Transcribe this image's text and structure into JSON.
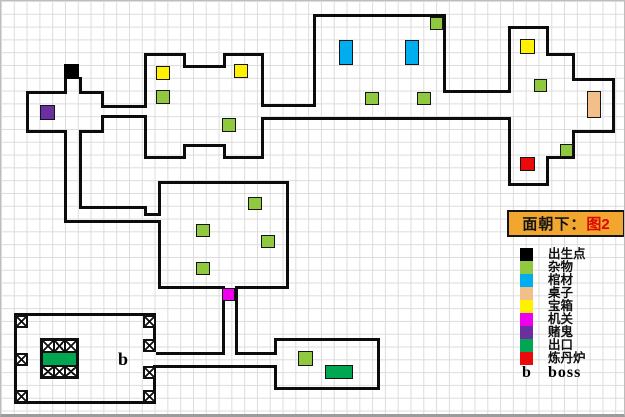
{
  "note": {
    "prefix": "面朝下：",
    "figure": "图2",
    "bg_color": "#F0A62F",
    "figure_color": "#DD0600"
  },
  "legend": {
    "items": [
      {
        "name": "spawn",
        "label": "出生点",
        "color": "#000000"
      },
      {
        "name": "junk",
        "label": "杂物",
        "color": "#90C93F"
      },
      {
        "name": "coffin",
        "label": "棺材",
        "color": "#00AEEF"
      },
      {
        "name": "table",
        "label": "桌子",
        "color": "#F2BE8A"
      },
      {
        "name": "chest",
        "label": "宝箱",
        "color": "#FFF100"
      },
      {
        "name": "mechanism",
        "label": "机关",
        "color": "#EE00EE"
      },
      {
        "name": "gambler",
        "label": "赌鬼",
        "color": "#6B2FA0"
      },
      {
        "name": "exit",
        "label": "出口",
        "color": "#00A651"
      },
      {
        "name": "furnace",
        "label": "炼丹炉",
        "color": "#EA0A0A"
      }
    ],
    "boss": {
      "symbol": "b",
      "label": "boss"
    }
  },
  "map": {
    "wall_color": "#0c0c0c",
    "grid_color": "#dcdcdc",
    "walls": [
      [
        25,
        90,
        41,
        3
      ],
      [
        78,
        90,
        25,
        3
      ],
      [
        25,
        90,
        3,
        42
      ],
      [
        25,
        129,
        41,
        3
      ],
      [
        78,
        129,
        25,
        3
      ],
      [
        100,
        90,
        3,
        17
      ],
      [
        100,
        114,
        3,
        18
      ],
      [
        63,
        76,
        3,
        16
      ],
      [
        78,
        76,
        3,
        16
      ],
      [
        100,
        104,
        46,
        3
      ],
      [
        100,
        114,
        46,
        3
      ],
      [
        143,
        52,
        42,
        3
      ],
      [
        182,
        52,
        3,
        15
      ],
      [
        182,
        64,
        43,
        3
      ],
      [
        222,
        52,
        3,
        15
      ],
      [
        222,
        52,
        41,
        3
      ],
      [
        143,
        52,
        3,
        52
      ],
      [
        143,
        117,
        3,
        41
      ],
      [
        143,
        155,
        42,
        3
      ],
      [
        182,
        143,
        3,
        15
      ],
      [
        182,
        143,
        43,
        3
      ],
      [
        222,
        143,
        3,
        15
      ],
      [
        222,
        155,
        41,
        3
      ],
      [
        260,
        52,
        3,
        51
      ],
      [
        260,
        116,
        3,
        42
      ],
      [
        260,
        103,
        55,
        3
      ],
      [
        260,
        116,
        250,
        3
      ],
      [
        312,
        13,
        133,
        3
      ],
      [
        312,
        13,
        3,
        90
      ],
      [
        442,
        13,
        3,
        76
      ],
      [
        442,
        89,
        68,
        3
      ],
      [
        507,
        25,
        41,
        3
      ],
      [
        507,
        25,
        3,
        64
      ],
      [
        507,
        117,
        3,
        68
      ],
      [
        507,
        182,
        41,
        3
      ],
      [
        545,
        155,
        3,
        30
      ],
      [
        545,
        155,
        29,
        3
      ],
      [
        571,
        129,
        3,
        29
      ],
      [
        571,
        129,
        43,
        3
      ],
      [
        611,
        77,
        3,
        55
      ],
      [
        571,
        77,
        43,
        3
      ],
      [
        571,
        52,
        3,
        28
      ],
      [
        545,
        52,
        29,
        3
      ],
      [
        545,
        25,
        3,
        30
      ],
      [
        157,
        180,
        131,
        3
      ],
      [
        157,
        180,
        3,
        32
      ],
      [
        157,
        219,
        3,
        69
      ],
      [
        285,
        180,
        3,
        108
      ],
      [
        157,
        285,
        67,
        3
      ],
      [
        234,
        285,
        54,
        3
      ],
      [
        63,
        129,
        3,
        93
      ],
      [
        78,
        129,
        3,
        79
      ],
      [
        78,
        205,
        68,
        3
      ],
      [
        143,
        205,
        3,
        10
      ],
      [
        143,
        212,
        17,
        3
      ],
      [
        63,
        219,
        97,
        3
      ],
      [
        221,
        285,
        3,
        69
      ],
      [
        234,
        285,
        3,
        69
      ],
      [
        155,
        351,
        66,
        3
      ],
      [
        234,
        351,
        42,
        3
      ],
      [
        155,
        364,
        121,
        3
      ],
      [
        13,
        312,
        142,
        3
      ],
      [
        13,
        312,
        3,
        91
      ],
      [
        13,
        400,
        142,
        3
      ],
      [
        152,
        312,
        3,
        39
      ],
      [
        152,
        364,
        3,
        39
      ],
      [
        273,
        337,
        106,
        3
      ],
      [
        273,
        337,
        3,
        14
      ],
      [
        273,
        364,
        3,
        25
      ],
      [
        273,
        386,
        106,
        3
      ],
      [
        376,
        337,
        3,
        52
      ]
    ],
    "items": [
      {
        "type": "spawn",
        "x": 63,
        "y": 63,
        "w": 15,
        "h": 15
      },
      {
        "type": "gambler",
        "x": 39,
        "y": 104,
        "w": 15,
        "h": 15
      },
      {
        "type": "chest",
        "x": 155,
        "y": 65,
        "w": 14,
        "h": 14
      },
      {
        "type": "junk",
        "x": 155,
        "y": 89,
        "w": 14,
        "h": 14
      },
      {
        "type": "chest",
        "x": 233,
        "y": 63,
        "w": 14,
        "h": 14
      },
      {
        "type": "junk",
        "x": 221,
        "y": 117,
        "w": 14,
        "h": 14
      },
      {
        "type": "coffin",
        "x": 338,
        "y": 39,
        "w": 14,
        "h": 25
      },
      {
        "type": "coffin",
        "x": 404,
        "y": 39,
        "w": 14,
        "h": 25
      },
      {
        "type": "junk",
        "x": 364,
        "y": 91,
        "w": 14,
        "h": 13
      },
      {
        "type": "junk",
        "x": 416,
        "y": 91,
        "w": 14,
        "h": 13
      },
      {
        "type": "junk",
        "x": 429,
        "y": 16,
        "w": 13,
        "h": 13
      },
      {
        "type": "chest",
        "x": 519,
        "y": 38,
        "w": 15,
        "h": 15
      },
      {
        "type": "junk",
        "x": 533,
        "y": 78,
        "w": 13,
        "h": 13
      },
      {
        "type": "table",
        "x": 586,
        "y": 90,
        "w": 14,
        "h": 27
      },
      {
        "type": "junk",
        "x": 559,
        "y": 143,
        "w": 13,
        "h": 13
      },
      {
        "type": "furnace",
        "x": 519,
        "y": 156,
        "w": 15,
        "h": 14
      },
      {
        "type": "junk",
        "x": 247,
        "y": 196,
        "w": 14,
        "h": 13
      },
      {
        "type": "junk",
        "x": 195,
        "y": 223,
        "w": 14,
        "h": 13
      },
      {
        "type": "junk",
        "x": 260,
        "y": 234,
        "w": 14,
        "h": 13
      },
      {
        "type": "junk",
        "x": 195,
        "y": 261,
        "w": 14,
        "h": 13
      },
      {
        "type": "mechanism",
        "x": 221,
        "y": 287,
        "w": 13,
        "h": 13
      },
      {
        "type": "junk",
        "x": 297,
        "y": 350,
        "w": 15,
        "h": 15
      },
      {
        "type": "exit",
        "x": 324,
        "y": 364,
        "w": 28,
        "h": 14
      }
    ],
    "x_boxes": [
      [
        14,
        314
      ],
      [
        142,
        314
      ],
      [
        14,
        352
      ],
      [
        14,
        389
      ],
      [
        142,
        389
      ],
      [
        142,
        338
      ],
      [
        142,
        365
      ]
    ],
    "boss_marker": {
      "text": "b"
    },
    "inner_structure": {
      "x": 39,
      "y": 337,
      "w": 39,
      "h": 41,
      "rows": [
        "x",
        "exit",
        "x"
      ],
      "cols": 3
    }
  }
}
